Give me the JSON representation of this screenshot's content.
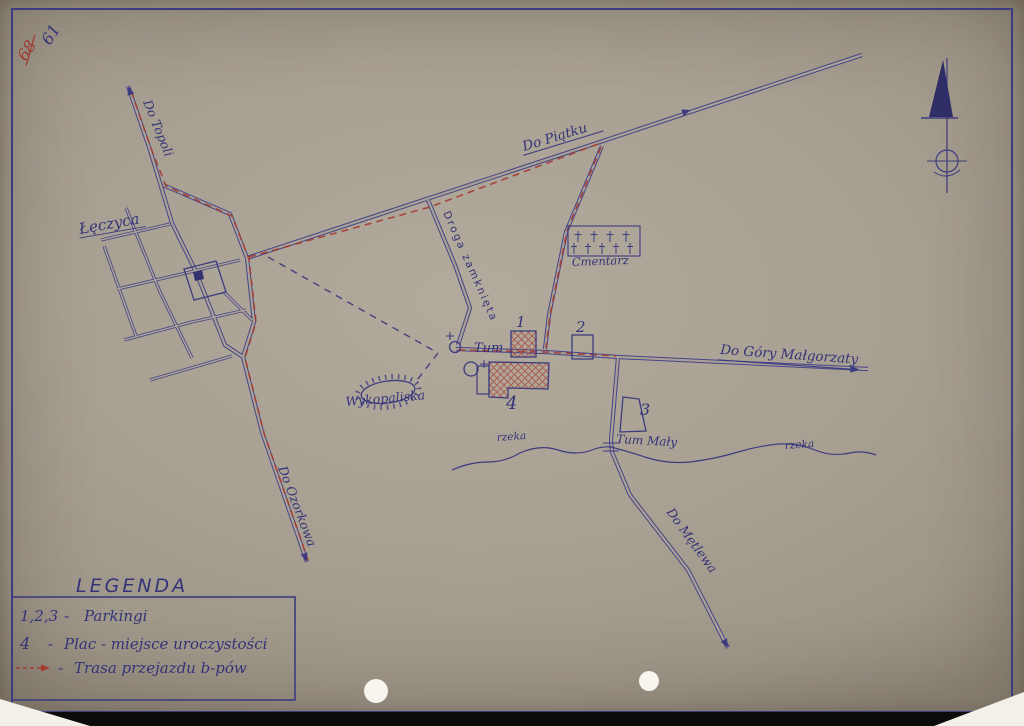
{
  "page": {
    "archival_note": {
      "crossed_number": "68",
      "number": "61"
    },
    "map": {
      "town_label": "Łęczyca",
      "road_labels": {
        "topoli": "Do Topoli",
        "piatku": "Do Piątku",
        "zamknieta": "Droga zamknięta",
        "gora_malgorzaty": "Do Góry Małgorzaty",
        "metlewa": "Do Mętlewa",
        "ozorkowa": "Do Ozorkowa"
      },
      "place_labels": {
        "tum": "Tum",
        "tum_maly": "Tum Mały",
        "cmentarz": "Cmentarz",
        "wykopaliska": "Wykopaliska",
        "rzeka": "rzeka"
      },
      "markers": {
        "p1": "1",
        "p2": "2",
        "p3": "3",
        "plac4": "4"
      }
    },
    "legend": {
      "title": "LEGENDA",
      "dash": "-",
      "entries": [
        {
          "symbol": "1,2,3",
          "label": "Parkingi"
        },
        {
          "symbol": "4",
          "label": "Plac - miejsce uroczystości"
        },
        {
          "symbol": "",
          "label": "Trasa przejazdu b-pów"
        }
      ]
    },
    "colors": {
      "ink": "#3d3c80",
      "route_red": "#a63c32",
      "paper": "#a9a193"
    }
  }
}
